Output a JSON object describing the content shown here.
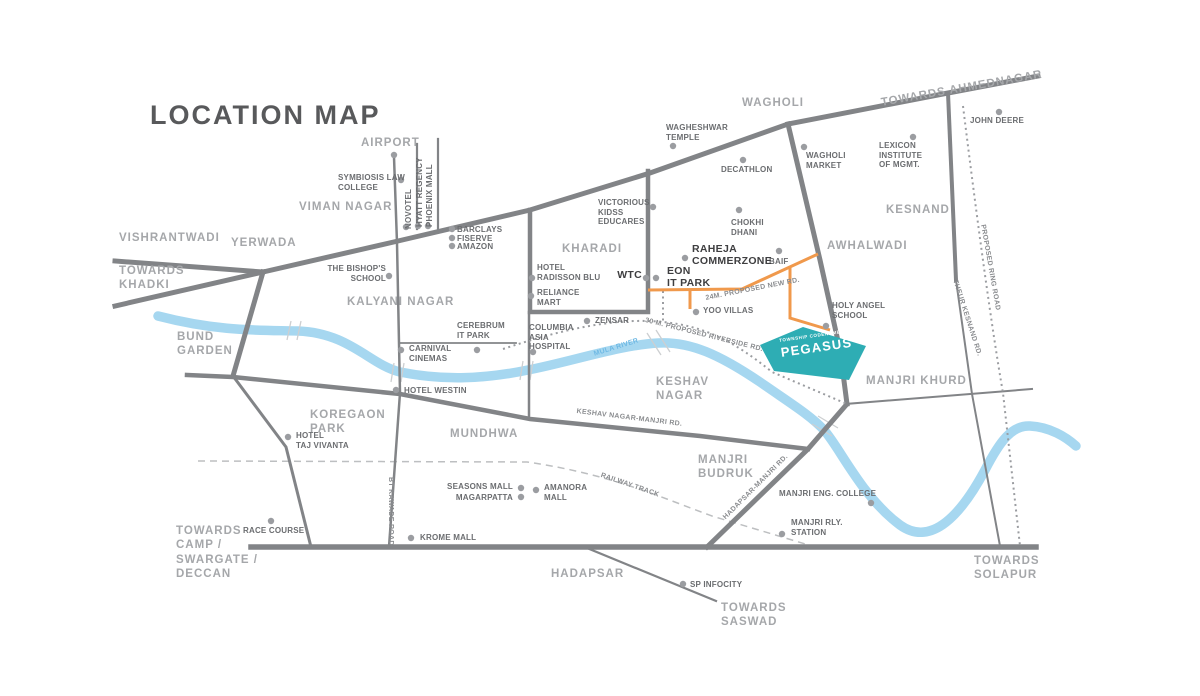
{
  "title": "LOCATION MAP",
  "colors": {
    "road": "#828487",
    "dot": "#9B9DA1",
    "river": "#A6D7F0",
    "river_label": "#6FB9E4",
    "orange_road": "#F0994C",
    "teal_site": "#2EADB4",
    "title_text": "#58595B",
    "locality_text": "#A5A7AA",
    "poi_text": "#6B6D70",
    "bold_poi_text": "#3E3E40",
    "road_label_text": "#8A8C8F",
    "railway": "#BDBFC1"
  },
  "township": {
    "tagline": "TOWNSHIP CODENAME",
    "name": "PEGASUS"
  },
  "localities": [
    {
      "name": "vishrantwadi",
      "text": "VISHRANTWADI",
      "x": 119,
      "y": 231
    },
    {
      "name": "towards-khadki",
      "text": "TOWARDS\nKHADKI",
      "x": 119,
      "y": 264
    },
    {
      "name": "yerwada",
      "text": "YERWADA",
      "x": 231,
      "y": 236
    },
    {
      "name": "viman-nagar",
      "text": "VIMAN NAGAR",
      "x": 299,
      "y": 200
    },
    {
      "name": "airport",
      "text": "AIRPORT",
      "x": 361,
      "y": 136,
      "dot": [
        394,
        155
      ]
    },
    {
      "name": "kalyani-nagar",
      "text": "KALYANI NAGAR",
      "x": 347,
      "y": 295
    },
    {
      "name": "bund-garden",
      "text": "BUND\nGARDEN",
      "x": 177,
      "y": 330
    },
    {
      "name": "koregaon-park",
      "text": "KOREGAON\nPARK",
      "x": 310,
      "y": 408
    },
    {
      "name": "mundhwa",
      "text": "MUNDHWA",
      "x": 450,
      "y": 427
    },
    {
      "name": "kharadi",
      "text": "KHARADI",
      "x": 562,
      "y": 242
    },
    {
      "name": "keshav-nagar",
      "text": "KESHAV\nNAGAR",
      "x": 656,
      "y": 375
    },
    {
      "name": "wagholi",
      "text": "WAGHOLI",
      "x": 742,
      "y": 96
    },
    {
      "name": "kesnand",
      "text": "KESNAND",
      "x": 886,
      "y": 203
    },
    {
      "name": "awhalwadi",
      "text": "AWHALWADI",
      "x": 827,
      "y": 239
    },
    {
      "name": "manjri-budruk",
      "text": "MANJRI\nBUDRUK",
      "x": 698,
      "y": 453
    },
    {
      "name": "manjri-khurd",
      "text": "MANJRI KHURD",
      "x": 866,
      "y": 374
    },
    {
      "name": "hadapsar",
      "text": "HADAPSAR",
      "x": 551,
      "y": 567
    },
    {
      "name": "towards-camp",
      "text": "TOWARDS\nCAMP /\nSWARGATE /\nDECCAN",
      "x": 176,
      "y": 524
    },
    {
      "name": "towards-saswad",
      "text": "TOWARDS\nSASWAD",
      "x": 721,
      "y": 601
    },
    {
      "name": "towards-solapur",
      "text": "TOWARDS\nSOLAPUR",
      "x": 974,
      "y": 554
    },
    {
      "name": "towards-ahmednagar",
      "text": "TOWARDS AHMEDNAGAR",
      "x": 880,
      "y": 96,
      "rotate": -10
    }
  ],
  "pois": [
    {
      "name": "symbiosis-law-college",
      "text": "SYMBIOSIS LAW\nCOLLEGE",
      "x": 338,
      "y": 173,
      "dot": [
        401,
        180
      ]
    },
    {
      "name": "novotel",
      "text": "NOVOTEL",
      "x": 404,
      "y": 229,
      "rotate": -90,
      "dot": [
        406,
        227
      ]
    },
    {
      "name": "hyatt-regency",
      "text": "HYATT REGENCY",
      "x": 415,
      "y": 227,
      "rotate": -90,
      "dot": [
        418,
        226
      ]
    },
    {
      "name": "phoenix-mall",
      "text": "PHOENIX MALL",
      "x": 425,
      "y": 227,
      "rotate": -90,
      "dot": [
        428,
        226
      ]
    },
    {
      "name": "barclays",
      "text": "BARCLAYS",
      "x": 457,
      "y": 225,
      "dot": [
        452,
        229
      ]
    },
    {
      "name": "fiserve",
      "text": "FISERVE",
      "x": 457,
      "y": 234,
      "dot": [
        452,
        238
      ]
    },
    {
      "name": "amazon",
      "text": "AMAZON",
      "x": 457,
      "y": 242,
      "dot": [
        452,
        246
      ]
    },
    {
      "name": "the-bishops-school",
      "text": "THE BISHOP'S\nSCHOOL",
      "x": 386,
      "y": 264,
      "align": "right",
      "dot": [
        389,
        276
      ]
    },
    {
      "name": "wagheshwar-temple",
      "text": "WAGHESHWAR\nTEMPLE",
      "x": 666,
      "y": 123,
      "dot": [
        673,
        146
      ]
    },
    {
      "name": "decathlon",
      "text": "DECATHLON",
      "x": 721,
      "y": 165,
      "dot": [
        743,
        160
      ]
    },
    {
      "name": "wagholi-market",
      "text": "WAGHOLI\nMARKET",
      "x": 806,
      "y": 151,
      "dot": [
        804,
        147
      ]
    },
    {
      "name": "lexicon-institute",
      "text": "LEXICON\nINSTITUTE\nOF MGMT.",
      "x": 879,
      "y": 141,
      "dot": [
        913,
        137
      ]
    },
    {
      "name": "john-deere",
      "text": "JOHN DEERE",
      "x": 970,
      "y": 116,
      "dot": [
        999,
        112
      ]
    },
    {
      "name": "chokhi-dhani",
      "text": "CHOKHI\nDHANI",
      "x": 731,
      "y": 218,
      "dot": [
        739,
        210
      ]
    },
    {
      "name": "baif",
      "text": "BAIF",
      "x": 769,
      "y": 257,
      "dot": [
        779,
        251
      ]
    },
    {
      "name": "victorious-kidss-educares",
      "text": "VICTORIOUS\nKIDSS\nEDUCARES",
      "x": 598,
      "y": 198,
      "dot": [
        653,
        207
      ]
    },
    {
      "name": "hotel-radisson-blu",
      "text": "HOTEL\nRADISSON BLU",
      "x": 537,
      "y": 263,
      "dot": [
        532,
        278
      ]
    },
    {
      "name": "reliance-mart",
      "text": "RELIANCE\nMART",
      "x": 537,
      "y": 288,
      "dot": [
        531,
        296
      ]
    },
    {
      "name": "zensar",
      "text": "ZENSAR",
      "x": 595,
      "y": 316,
      "dot": [
        587,
        321
      ]
    },
    {
      "name": "columbia-asia-hospital",
      "text": "COLUMBIA\nASIA\nHOSPITAL",
      "x": 529,
      "y": 323,
      "dot": [
        533,
        352
      ]
    },
    {
      "name": "cerebrum-it-park",
      "text": "CEREBRUM\nIT PARK",
      "x": 457,
      "y": 321,
      "dot": [
        477,
        350
      ]
    },
    {
      "name": "carnival-cinemas",
      "text": "CARNIVAL\nCINEMAS",
      "x": 409,
      "y": 344,
      "dot": [
        401,
        350
      ]
    },
    {
      "name": "hotel-westin",
      "text": "HOTEL WESTIN",
      "x": 404,
      "y": 386,
      "dot": [
        396,
        390
      ]
    },
    {
      "name": "hotel-taj-vivanta",
      "text": "HOTEL\nTAJ VIVANTA",
      "x": 296,
      "y": 431,
      "dot": [
        288,
        437
      ]
    },
    {
      "name": "race-course",
      "text": "RACE COURSE",
      "x": 243,
      "y": 526,
      "dot": [
        271,
        521
      ]
    },
    {
      "name": "krome-mall",
      "text": "KROME MALL",
      "x": 420,
      "y": 533,
      "dot": [
        411,
        538
      ]
    },
    {
      "name": "seasons-mall",
      "text": "SEASONS MALL",
      "x": 513,
      "y": 482,
      "align": "right",
      "dot": [
        521,
        488
      ]
    },
    {
      "name": "magarpatta",
      "text": "MAGARPATTA",
      "x": 513,
      "y": 493,
      "align": "right",
      "dot": [
        521,
        497
      ]
    },
    {
      "name": "amanora-mall",
      "text": "AMANORA\nMALL",
      "x": 544,
      "y": 483,
      "dot": [
        536,
        490
      ]
    },
    {
      "name": "sp-infocity",
      "text": "SP INFOCITY",
      "x": 690,
      "y": 580,
      "dot": [
        683,
        584
      ]
    },
    {
      "name": "yoo-villas",
      "text": "YOO VILLAS",
      "x": 703,
      "y": 306,
      "dot": [
        696,
        312
      ]
    },
    {
      "name": "holy-angel-school",
      "text": "HOLY ANGEL\nSCHOOL",
      "x": 832,
      "y": 301,
      "dot": [
        826,
        326
      ]
    },
    {
      "name": "manjri-eng-college",
      "text": "MANJRI ENG. COLLEGE",
      "x": 779,
      "y": 489,
      "dot": [
        871,
        503
      ]
    },
    {
      "name": "manjri-rly-station",
      "text": "MANJRI RLY.\nSTATION",
      "x": 791,
      "y": 518,
      "dot": [
        782,
        534
      ]
    }
  ],
  "landmarks_bold": [
    {
      "name": "wtc",
      "text": "WTC",
      "x": 642,
      "y": 269,
      "align": "right",
      "dots": [
        [
          646,
          278
        ],
        [
          656,
          278
        ]
      ]
    },
    {
      "name": "eon-it-park",
      "text": "EON\nIT PARK",
      "x": 667,
      "y": 265
    },
    {
      "name": "raheja-commerzone",
      "text": "RAHEJA\nCOMMERZONE",
      "x": 692,
      "y": 243,
      "dot": [
        685,
        258
      ]
    }
  ],
  "road_labels": [
    {
      "name": "24m-proposed-new-rd",
      "text": "24M. PROPOSED NEW RD.",
      "x": 705,
      "y": 295,
      "rotate": -11
    },
    {
      "name": "30m-proposed-riverside-rd",
      "text": "30 M. PROPOSED RIVERSIDE RD.",
      "x": 646,
      "y": 317,
      "rotate": 14
    },
    {
      "name": "keshav-nagar-manjri-rd",
      "text": "KESHAV NAGAR-MANJRI RD.",
      "x": 577,
      "y": 408,
      "rotate": 7
    },
    {
      "name": "railway-track",
      "text": "RAILWAY TRACK",
      "x": 602,
      "y": 472,
      "rotate": 19
    },
    {
      "name": "hadapsar-manjri-rd",
      "text": "HADAPSAR-MANJRI RD.",
      "x": 722,
      "y": 516,
      "rotate": -45
    },
    {
      "name": "proposed-ring-road",
      "text": "PROPOSED RING ROAD",
      "x": 986,
      "y": 224,
      "rotate": 80
    },
    {
      "name": "theur-kesnand-rd",
      "text": "THEUR KESNAND RD.",
      "x": 958,
      "y": 279,
      "rotate": 72
    },
    {
      "name": "bt-kawade-road",
      "text": "BT KAWADE ROAD",
      "x": 394,
      "y": 477,
      "rotate": 90
    },
    {
      "name": "mula-river",
      "text": "MULA RIVER",
      "x": 593,
      "y": 351,
      "rotate": -17,
      "river": true
    }
  ]
}
